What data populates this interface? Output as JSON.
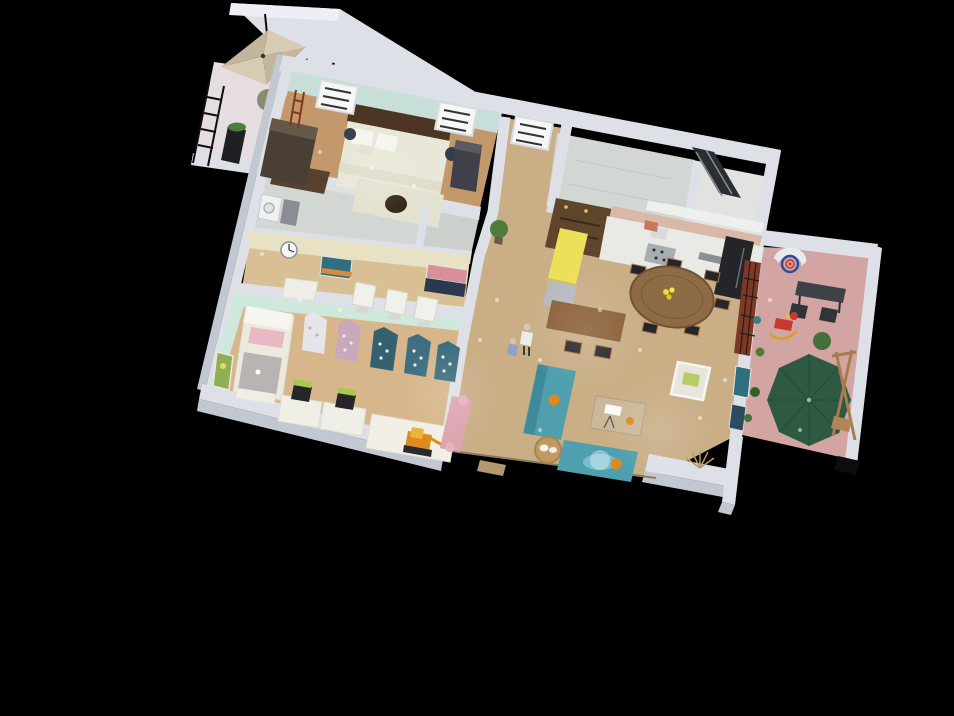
{
  "app": {
    "description": "Isometric cutaway 3D floor plan render of an apartment on a black background"
  },
  "colors": {
    "background": "#000000",
    "wallLight": "#dde1e7",
    "wallShade": "#c2c8d1",
    "wallTop": "#eceff3",
    "mintWall": "#c8ded8",
    "kidsMint": "#cfe8dc",
    "creamWall": "#e8e1c4",
    "floorBedroom": "#c3986a",
    "floorOpen": "#c9ae86",
    "floorKids": "#d7b68b",
    "floorStudy": "#d9c094",
    "floorMarble": "#d3d7d3",
    "floorBalcony": "#e5dde0",
    "floorPatio": "#d2a5a3",
    "umbrellaBeige": "#d8cbb5",
    "umbrellaBeigeDark": "#c4b69d",
    "patioUmbrella": "#2e5a43",
    "sofaTeal": "#4f9fae",
    "accentYellow": "#ecdf59",
    "woodAccent": "#5f452c",
    "headboard": "#4c3623",
    "bedding": "#e9e8d8",
    "tableWood": "#8d6b46",
    "barWood": "#8a5f38",
    "counterWhite": "#e9eae6",
    "applianceBlack": "#232529",
    "chairBlack": "#26262a",
    "chairGreen": "#a8c84e",
    "pinkBlanket": "#e9b8c4",
    "daybedPink": "#dca4b0",
    "mauveHouse": "#c9a8bc",
    "tealHouse": "#3e6f80",
    "tealHouseDark": "#35616f",
    "whiteItem": "#f2f2ee",
    "frameRed": "#7c3a26",
    "hoopBlue": "#2b4f9e",
    "hoopRed": "#c03a30",
    "toyOrange": "#e08a1e",
    "plantGreen": "#4e7c3a",
    "basketTan": "#c09a62",
    "stairsDark": "#2a2d31",
    "artTeal": "#2e6f80",
    "artPink": "#d88f98",
    "artNavy": "#2a3850",
    "artGreen": "#8fae58",
    "benchDark": "#3e4246",
    "rugBrown": "#56422e",
    "dresserBrown": "#4a3f34",
    "backsplash": "#d9b8a6"
  },
  "scene": {
    "rooms": [
      {
        "name": "balcony",
        "items": [
          "square-umbrella",
          "ladder-railing",
          "planter-box",
          "bush"
        ]
      },
      {
        "name": "bedroom",
        "items": [
          "double-bed",
          "tufted-headboard",
          "foot-bench-with-pet-nook",
          "dresser",
          "rug",
          "plant-vase",
          "plant-vase",
          "arched-window",
          "arched-window",
          "closet"
        ]
      },
      {
        "name": "bathroom",
        "items": [
          "marble-floor",
          "washer",
          "cabinet"
        ]
      },
      {
        "name": "study-nook",
        "items": [
          "wall-clock",
          "abstract-painting",
          "abstract-painting",
          "white-desk",
          "white-chair",
          "white-chair",
          "white-chair"
        ]
      },
      {
        "name": "kids-room",
        "items": [
          "canopy-bed",
          "house-shelf-white",
          "house-shelf-pink",
          "house-shelf-teal",
          "house-shelf-teal",
          "house-shelf-teal",
          "desk",
          "desk",
          "green-chair",
          "green-chair",
          "play-mat",
          "toy-excavator",
          "pink-daybed",
          "green-wall-art"
        ]
      },
      {
        "name": "hallway",
        "items": [
          "potted-plant",
          "adult-figure",
          "child-figure",
          "door-step"
        ]
      },
      {
        "name": "kitchen",
        "items": [
          "wood-accent-wall",
          "upper-cabinets",
          "counter-run",
          "stove",
          "sink",
          "black-fridge",
          "yellow-island",
          "base-cabinet"
        ]
      },
      {
        "name": "dining",
        "items": [
          "round-wood-table",
          "flower-centerpiece",
          "dining-chair-x6",
          "bar-table",
          "stool",
          "stool"
        ]
      },
      {
        "name": "living-room",
        "items": [
          "teal-sofa",
          "teal-sofa",
          "coffee-table",
          "white-armchair",
          "pet-basket-with-cat",
          "pink-bench",
          "low-console-wall",
          "dried-plant",
          "red-frame-glass-partition",
          "teal-wall-art",
          "navy-wall-art"
        ]
      },
      {
        "name": "upper-bathroom",
        "items": [
          "marble-walls",
          "dark-stair-panel"
        ]
      },
      {
        "name": "patio",
        "items": [
          "basketball-hoop",
          "dark-bench",
          "patio-chair",
          "patio-chair",
          "rocking-horse",
          "green-parasol",
          "wood-swing-frame",
          "potted-plants"
        ]
      }
    ]
  }
}
